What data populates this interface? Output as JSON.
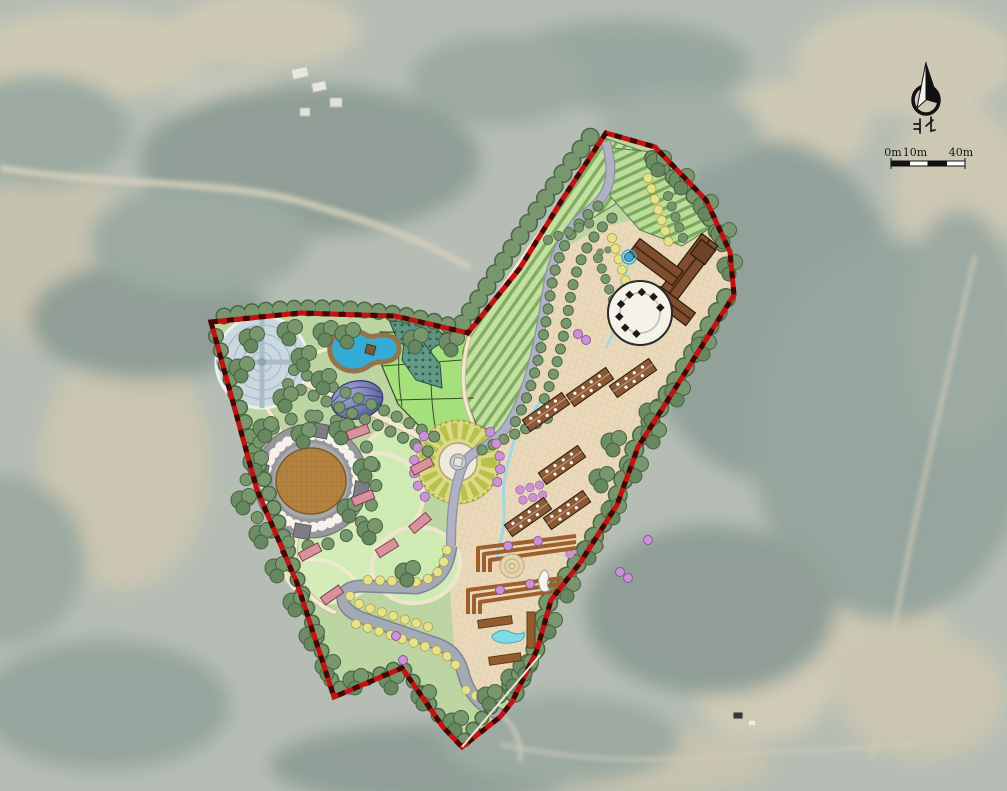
{
  "map": {
    "compass": {
      "label": "北",
      "icon": "compass-needle-icon"
    },
    "scale_bar": {
      "labels": [
        "0m",
        "10m",
        "40m"
      ]
    },
    "palette": {
      "aerial_base": "#aab3a8",
      "boundary_red": "#c41212",
      "boundary_dash": "#2a0603",
      "lawn_green": "#bcd5a2",
      "field_stripe_light": "#c3e0a0",
      "field_stripe_dark": "#7fae63",
      "bright_field_green": "#a4e07c",
      "orchard_teal": "#5f9483",
      "plaza_paving": "#ead9ba",
      "road_lavender": "#b0b2c4",
      "road_gray": "#a4a9b6",
      "path_cream": "#f2ead0",
      "water_blue": "#35acd6",
      "stream_cyan": "#9fd9e5",
      "building_brown": "#8a5a38",
      "cabin_pink": "#d9929d",
      "stadium_field_brown": "#b5823f",
      "plaza_circle_blue": "#cbd8e0",
      "dome_purple": "#7a7fc0",
      "tree_sage": "#74936c",
      "tree_yellow": "#e3df86",
      "tree_pink": "#c98ed3"
    }
  }
}
